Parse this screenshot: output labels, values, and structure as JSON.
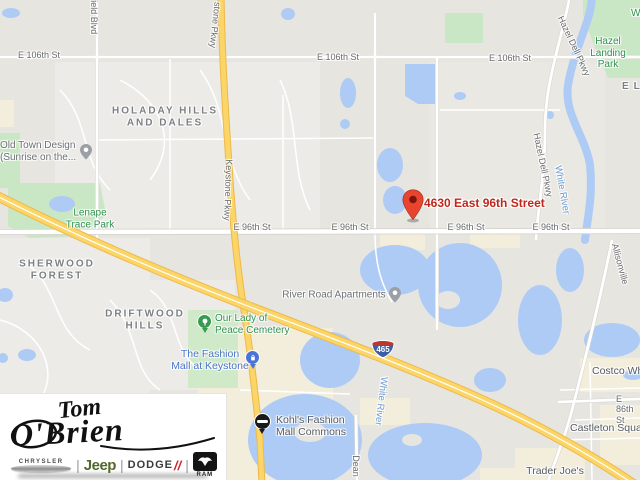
{
  "map": {
    "marker": {
      "label": "4630 East 96th Street"
    },
    "streets": {
      "e106": "E 106th St",
      "e96": "E 96th St",
      "e86": "E 86th St",
      "westfield": "field Blvd",
      "keystone_top": "stone Pkwy",
      "keystone": "Keystone Pkwy",
      "hazel_dell": "Hazel Dell Pkwy",
      "allisonville": "Allisonville",
      "dean": "Dean"
    },
    "water_labels": {
      "white_river": "White River",
      "w_trunc": "W"
    },
    "neighborhoods": {
      "holaday": "HOLADAY HILLS\nAND DALES",
      "sherwood": "SHERWOOD\nFOREST",
      "driftwood": "DRIFTWOOD\nHILLS",
      "el": "EL"
    },
    "parks": {
      "lenape": "Lenape\nTrace Park",
      "hazel_landing": "Hazel\nLanding Park",
      "cemetery": "Our Lady of\nPeace Cemetery"
    },
    "pois": {
      "old_town": "Old Town Design\n(Sunrise on the...",
      "river_road": "River Road Apartments",
      "fashion_mall": "The Fashion\nMall at Keystone",
      "kohls": "Kohl's Fashion\nMall Commons",
      "costco": "Costco Wholesale",
      "castleton": "Castleton Square",
      "trader_joes": "Trader Joe's"
    },
    "shield": {
      "route": "465"
    },
    "colors": {
      "water": "#aecbf5",
      "park_green": "#c9e7c4",
      "highway_yellow": "#fbd567",
      "marker_red": "#e8442e",
      "marker_text_red": "#c0261b"
    }
  },
  "logo": {
    "dealer_first": "Tom",
    "dealer_last": "O'Brien",
    "brands": {
      "chrysler": "CHRYSLER",
      "jeep": "Jeep",
      "dodge": "DODGE",
      "dodge_slash": "//",
      "ram": "RAM"
    }
  }
}
